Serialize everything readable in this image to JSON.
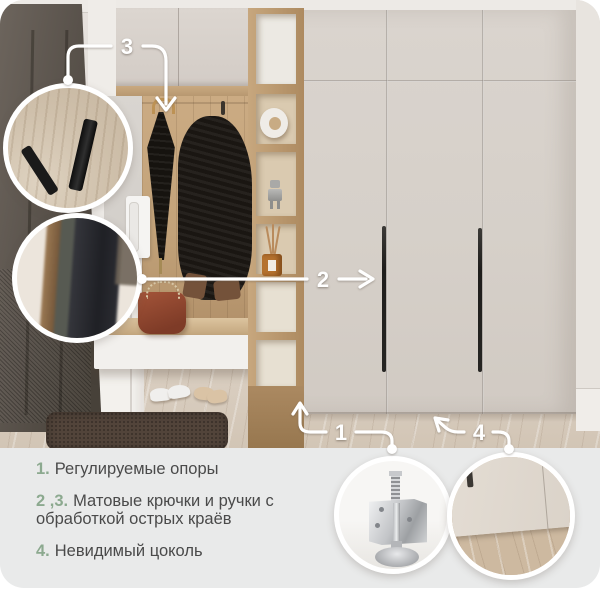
{
  "callouts": {
    "c1": "1",
    "c2": "2",
    "c3": "3",
    "c4": "4"
  },
  "features": [
    {
      "num": "1.",
      "text": "Регулируемые опоры"
    },
    {
      "num": "2 ,3.",
      "text": "Матовые крючки и ручки с обработкой острых краёв"
    },
    {
      "num": "4.",
      "text": "Невидимый цоколь"
    }
  ],
  "colors": {
    "accent_green": "#8ca98f",
    "body_text": "#4a4a4a",
    "panel_background": "#e9eaea",
    "callout_white": "#ffffff",
    "wardrobe_beige": "#d6d0c9",
    "wood_oak": "#c2a279"
  }
}
